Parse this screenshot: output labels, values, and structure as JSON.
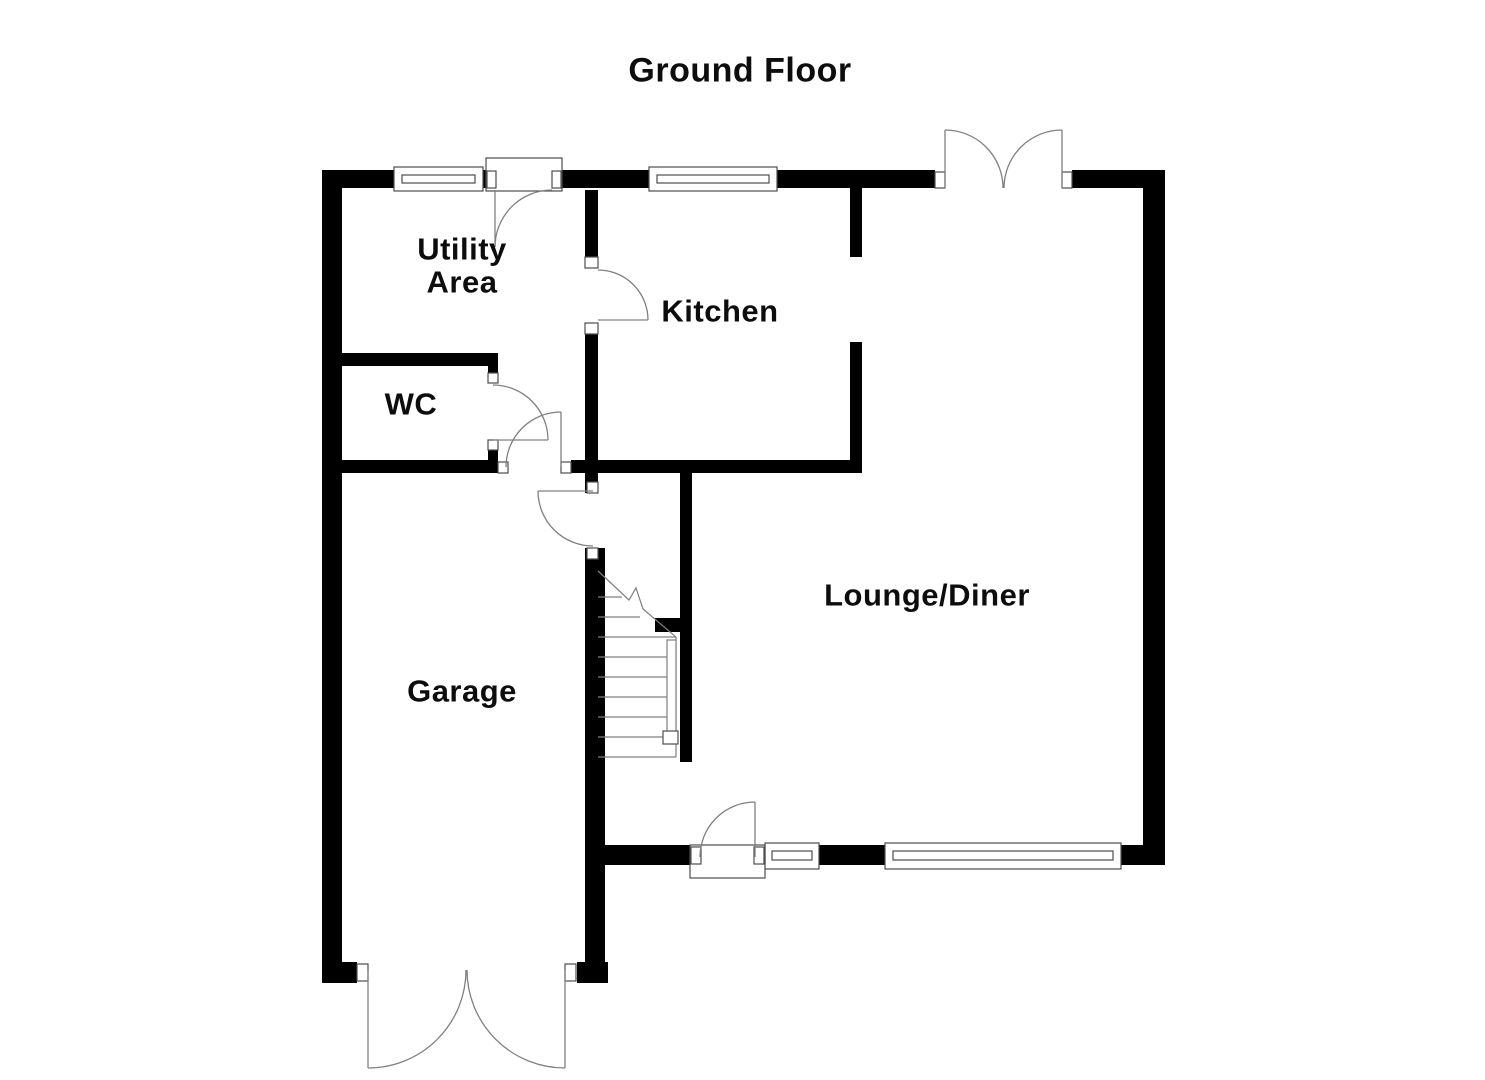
{
  "title": "Ground Floor",
  "rooms": {
    "utility_area": "Utility\nArea",
    "kitchen": "Kitchen",
    "wc": "WC",
    "garage": "Garage",
    "lounge_diner": "Lounge/Diner"
  },
  "colors": {
    "walls": "#000000",
    "background": "#ffffff",
    "detail_lines": "#808080",
    "frame_lines": "#4d4d4d",
    "text": "#0d0d0d"
  }
}
